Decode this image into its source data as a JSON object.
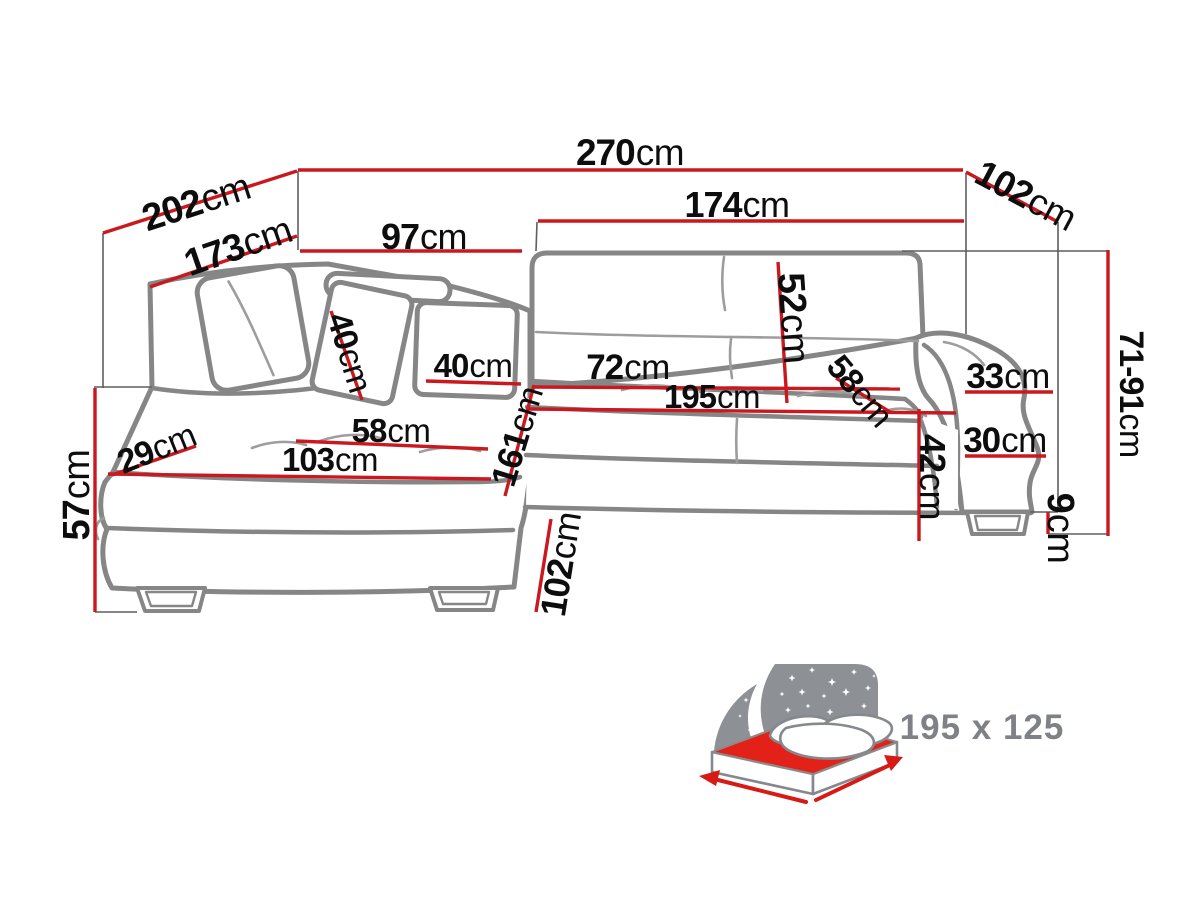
{
  "diagram": {
    "dims": {
      "total_width": {
        "v": "270",
        "u": "cm"
      },
      "chaise_depth_outer": {
        "v": "202",
        "u": "cm"
      },
      "chaise_depth_inner": {
        "v": "173",
        "u": "cm"
      },
      "back_left_width": {
        "v": "97",
        "u": "cm"
      },
      "seat_width_right": {
        "v": "174",
        "u": "cm"
      },
      "right_depth_top": {
        "v": "102",
        "u": "cm"
      },
      "backrest_height": {
        "v": "52",
        "u": "cm"
      },
      "height_range": {
        "v": "71-91",
        "u": "cm"
      },
      "armrest_top_width": {
        "v": "33",
        "u": "cm"
      },
      "armrest_width": {
        "v": "30",
        "u": "cm"
      },
      "seat_height_front": {
        "v": "42",
        "u": "cm"
      },
      "leg_height": {
        "v": "9",
        "u": "cm"
      },
      "seat_depth_diag": {
        "v": "58",
        "u": "cm"
      },
      "seat_depth": {
        "v": "72",
        "u": "cm"
      },
      "bed_length": {
        "v": "195",
        "u": "cm"
      },
      "armrest_left_width": {
        "v": "29",
        "u": "cm"
      },
      "chaise_length": {
        "v": "103",
        "u": "cm"
      },
      "seat_width_left": {
        "v": "58",
        "u": "cm"
      },
      "chaise_total_depth": {
        "v": "161",
        "u": "cm"
      },
      "pillow_a": {
        "v": "40",
        "u": "cm"
      },
      "pillow_b": {
        "v": "40",
        "u": "cm"
      },
      "seat_height_left": {
        "v": "57",
        "u": "cm"
      },
      "chaise_front_depth": {
        "v": "102",
        "u": "cm"
      }
    }
  },
  "bed_icon": {
    "size_label": "195 x 125"
  },
  "colors": {
    "dimension_red": "#c9191f",
    "sofa_outline_gray": "#868686",
    "label_black": "#0d0d0d",
    "bed_gray": "#8d9196",
    "mattress_red": "#e32119",
    "bed_text_gray": "#7e8286"
  }
}
